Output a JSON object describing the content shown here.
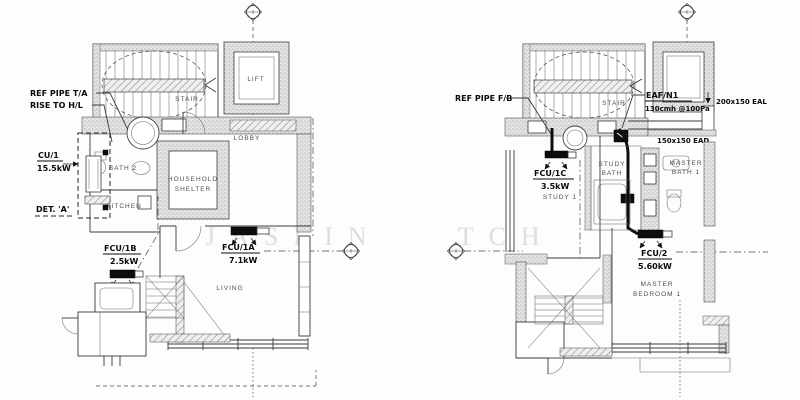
{
  "watermark": "JASLIN TCH",
  "left_plan": {
    "rooms": {
      "stair": "STAIR",
      "lift": "LIFT",
      "lobby": "LOBBY",
      "bath2": "BATH 2",
      "hs1": "HOUSEHOLD",
      "hs2": "SHELTER",
      "kitchen": "KITCHEN",
      "living": "LIVING"
    },
    "ann": {
      "ref1": "REF PIPE T/A",
      "ref2": "RISE TO H/L",
      "cu1": "CU/1",
      "cu1_cap": "15.5kW",
      "det": "DET. 'A'",
      "fcu1b": "FCU/1B",
      "fcu1b_cap": "2.5kW",
      "fcu1a": "FCU/1A",
      "fcu1a_cap": "7.1kW"
    }
  },
  "right_plan": {
    "rooms": {
      "stair": "STAIR",
      "study1": "STUDY 1",
      "sb1": "STUDY",
      "sb2": "BATH",
      "mb1": "MASTER",
      "mb2": "BATH 1",
      "mbr1": "MASTER",
      "mbr2": "BEDROOM 1"
    },
    "ann": {
      "ref": "REF PIPE F/B",
      "eaf": "EAF/N1",
      "eaf_cap": "130cmh @100Pa",
      "eal": "200x150 EAL",
      "ead": "150x150 EAD",
      "fcu1c": "FCU/1C",
      "fcu1c_cap": "3.5kW",
      "fcu2": "FCU/2",
      "fcu2_cap": "5.60kW"
    }
  }
}
